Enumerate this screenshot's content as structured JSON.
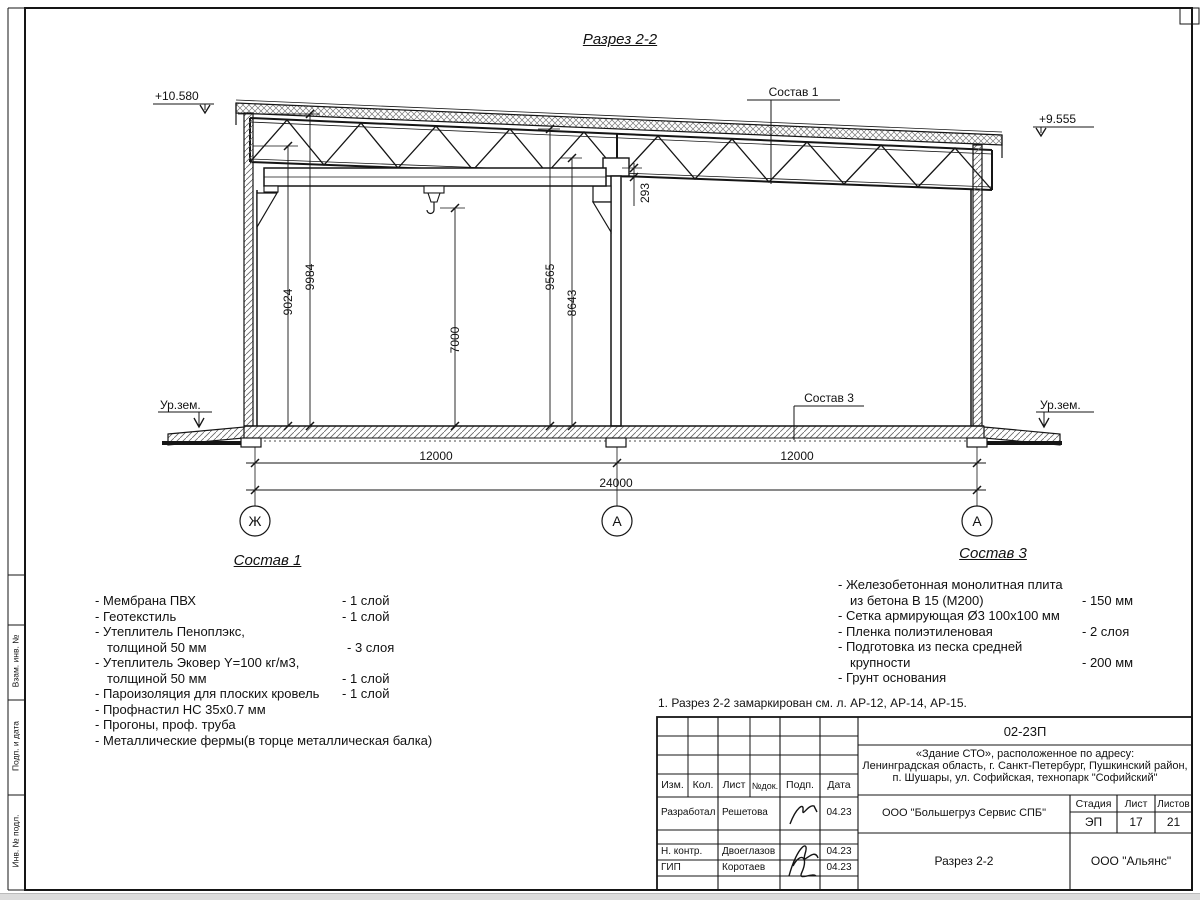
{
  "drawing": {
    "title": "Разрез 2-2",
    "elevation_left": "+10.580",
    "elevation_right": "+9.555",
    "ground_left": "Ур.зем.",
    "ground_right": "Ур.зем.",
    "leader_roof": "Состав 1",
    "leader_floor": "Состав 3",
    "dims": {
      "v1": "9024",
      "v2": "9984",
      "v3": "7000",
      "v4": "9565",
      "v5": "8643",
      "v6": "293",
      "span1": "12000",
      "span2": "12000",
      "total": "24000"
    },
    "axes": {
      "a1": "Ж",
      "a2": "А",
      "a3": "А"
    }
  },
  "sostav1": {
    "title": "Состав 1",
    "rows": [
      {
        "n": "- Мембрана ПВХ",
        "q": "- 1 слой"
      },
      {
        "n": "- Геотекстиль",
        "q": "- 1 слой"
      },
      {
        "n": "- Утеплитель Пеноплэкс,",
        "q": ""
      },
      {
        "n": "толщиной 50 мм",
        "q": "- 3 слоя"
      },
      {
        "n": "- Утеплитель Эковер Y=100 кг/м3,",
        "q": ""
      },
      {
        "n": "толщиной 50 мм",
        "q": "- 1 слой"
      },
      {
        "n": "- Пароизоляция для плоских кровель",
        "q": "- 1 слой"
      },
      {
        "n": "- Профнастил НС 35х0.7 мм",
        "q": ""
      },
      {
        "n": "- Прогоны, проф. труба",
        "q": ""
      },
      {
        "n": "- Металлические фермы(в торце металлическая балка)",
        "q": ""
      }
    ]
  },
  "sostav3": {
    "title": "Состав 3",
    "rows": [
      {
        "n": "- Железобетонная  монолитная плита",
        "q": ""
      },
      {
        "n": "из бетона В 15 (М200)",
        "q": "- 150 мм"
      },
      {
        "n": "- Сетка армирующая Ø3 100х100 мм",
        "q": ""
      },
      {
        "n": "- Пленка полиэтиленовая",
        "q": "- 2 слоя"
      },
      {
        "n": "- Подготовка из песка средней",
        "q": ""
      },
      {
        "n": "крупности",
        "q": "- 200 мм"
      },
      {
        "n": "- Грунт основания",
        "q": ""
      }
    ]
  },
  "note": "1. Разрез 2-2 замаркирован см. л. АР-12, АР-14, АР-15.",
  "stamp": {
    "code": "02-23П",
    "desc1": "«Здание СТО», расположенное по адресу:",
    "desc2": "Ленинградская область, г. Санкт-Петербург, Пушкинский район,",
    "desc3": "п. Шушары, ул. Софийская, технопарк \"Софийский\"",
    "header": {
      "izm": "Изм.",
      "kol": "Кол.",
      "list": "Лист",
      "ndok": "№док.",
      "podp": "Подп.",
      "data": "Дата"
    },
    "row1": {
      "role": "Разработал",
      "name": "Решетова",
      "date": "04.23"
    },
    "row2": {
      "role": "Н. контр.",
      "name": "Двоеглазов",
      "date": "04.23"
    },
    "row3": {
      "role": "ГИП",
      "name": "Коротаев",
      "date": "04.23"
    },
    "org": "ООО \"Большегруз Сервис СПБ\"",
    "doc_title": "Разрез 2-2",
    "firm": "ООО \"Альянс\"",
    "stage_label": "Стадия",
    "sheet_label": "Лист",
    "sheets_label": "Листов",
    "stage": "ЭП",
    "sheet": "17",
    "sheets": "21"
  },
  "side": {
    "l1": "Взам. инв. №",
    "l2": "Подп. и дата",
    "l3": "Инв. № подл."
  }
}
